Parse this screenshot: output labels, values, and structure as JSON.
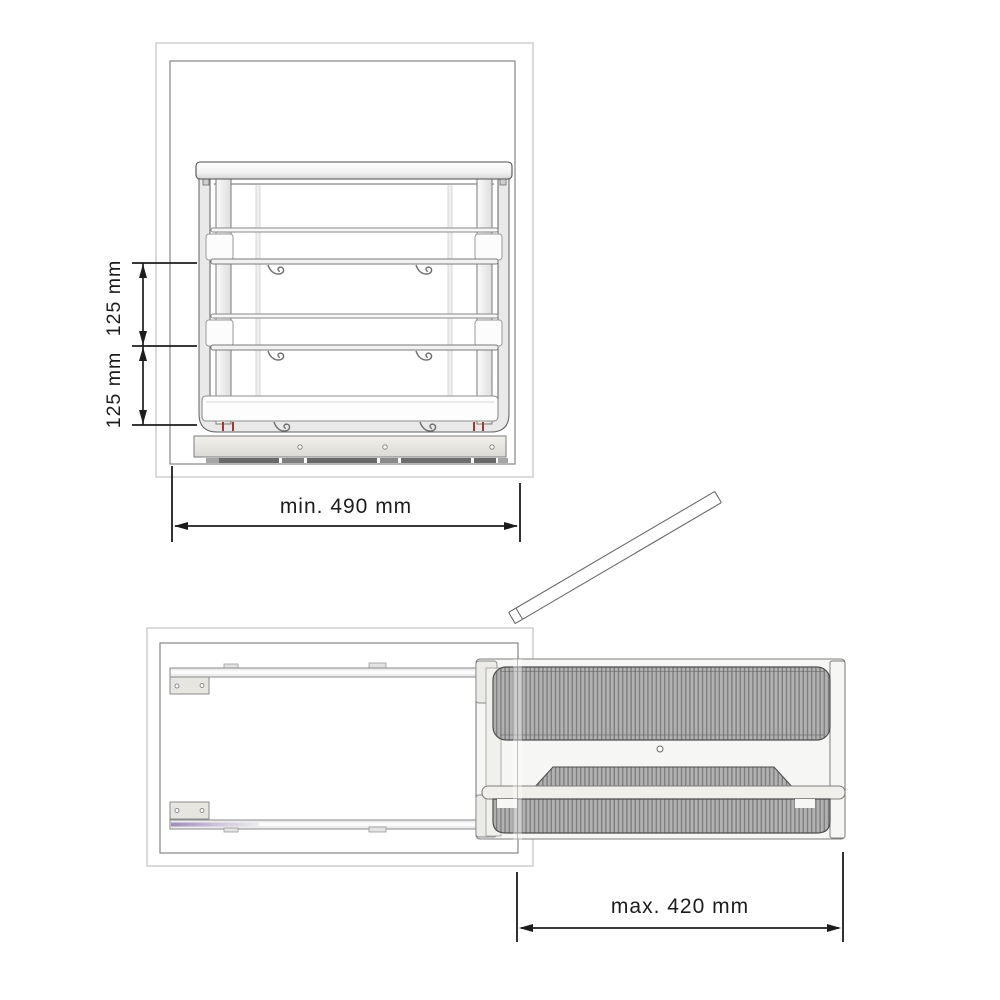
{
  "title": "Pull-out shoe rack technical drawing",
  "views": {
    "front_elevation": {
      "name": "front elevation with cabinet outline",
      "dimensions": {
        "shelf_spacing_upper": "125 mm",
        "shelf_spacing_lower": "125 mm",
        "cabinet_min_width": "min. 490 mm"
      }
    },
    "top_plan": {
      "name": "top view with rack pulled out and door open",
      "dimensions": {
        "max_extension": "max. 420 mm"
      }
    }
  },
  "colors": {
    "background": "#ffffff",
    "dimension_lines": "#1c1c1c",
    "drawing_outline": "#4f4f4f",
    "cabinet_outline_inner": "#8f8f8f",
    "cabinet_outline_outer": "#c6c6c6",
    "metal_fill": "#e9e9e9",
    "ribbed_fill": "#b2b2b2",
    "ribbed_line": "#7d7d7d",
    "accent_red_tick": "#9c3b33",
    "accent_lavender_rail": "#9f8cba"
  }
}
